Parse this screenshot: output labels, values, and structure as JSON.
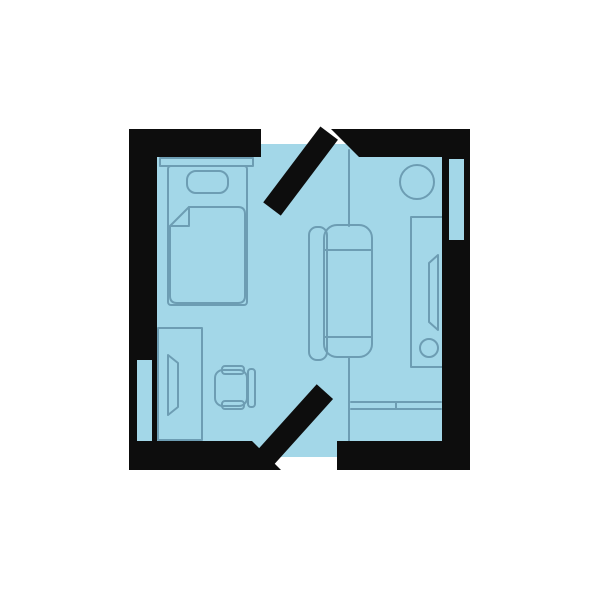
{
  "scene": {
    "type": "floor-plan-illustration",
    "canvas": {
      "width": 600,
      "height": 600,
      "background": "#FFFFFF"
    },
    "colors": {
      "floor": "#A3D7E8",
      "outline": "#6D9DB3",
      "wall": "#0D0D0D"
    },
    "rooms": [
      {
        "name": "bedroom-left",
        "contents": [
          "bed",
          "desk",
          "monitor",
          "office-chair"
        ]
      },
      {
        "name": "living-area-right",
        "contents": [
          "sofa",
          "tv-cabinet",
          "tv",
          "round-stool",
          "wall-shelf"
        ]
      }
    ],
    "elements": [
      {
        "name": "floor-area",
        "kind": "floor",
        "bbox": [
          144,
          144,
          312,
          313
        ]
      },
      {
        "name": "wall-top-left",
        "kind": "wall",
        "bbox": [
          129,
          129,
          132,
          28
        ]
      },
      {
        "name": "wall-top-right",
        "kind": "wall",
        "bbox": [
          331,
          129,
          139,
          28
        ],
        "note": "diagonal-cut left end"
      },
      {
        "name": "wall-left",
        "kind": "wall",
        "bbox": [
          129,
          129,
          28,
          341
        ]
      },
      {
        "name": "wall-right",
        "kind": "wall",
        "bbox": [
          442,
          129,
          28,
          341
        ]
      },
      {
        "name": "wall-bottom-left",
        "kind": "wall",
        "bbox": [
          129,
          441,
          152,
          29
        ],
        "note": "diagonal-cut right end"
      },
      {
        "name": "wall-bottom-right",
        "kind": "wall",
        "bbox": [
          337,
          441,
          133,
          29
        ]
      },
      {
        "name": "window-left",
        "kind": "window",
        "bbox": [
          137,
          360,
          15,
          81
        ]
      },
      {
        "name": "window-right",
        "kind": "window",
        "bbox": [
          449,
          159,
          15,
          81
        ]
      },
      {
        "name": "door-leaf-top",
        "kind": "door",
        "from": [
          272,
          209
        ],
        "to": [
          329,
          133
        ],
        "thickness": 22
      },
      {
        "name": "door-leaf-bottom",
        "kind": "door",
        "from": [
          266,
          457
        ],
        "to": [
          325,
          392
        ],
        "thickness": 22
      },
      {
        "name": "bed-headboard",
        "kind": "furniture",
        "bbox": [
          160,
          158,
          93,
          8
        ]
      },
      {
        "name": "bed-frame",
        "kind": "furniture",
        "bbox": [
          168,
          166,
          79,
          139
        ]
      },
      {
        "name": "bed-pillow",
        "kind": "furniture",
        "bbox": [
          187,
          171,
          41,
          22
        ]
      },
      {
        "name": "bed-blanket",
        "kind": "furniture",
        "bbox": [
          170,
          207,
          75,
          96
        ],
        "note": "folded top-left corner"
      },
      {
        "name": "desk",
        "kind": "furniture",
        "bbox": [
          158,
          328,
          44,
          112
        ]
      },
      {
        "name": "monitor",
        "kind": "furniture",
        "bbox": [
          168,
          355,
          10,
          60
        ]
      },
      {
        "name": "office-chair",
        "kind": "furniture",
        "bbox": [
          215,
          366,
          40,
          43
        ]
      },
      {
        "name": "sofa",
        "kind": "furniture",
        "bbox": [
          309,
          225,
          63,
          135
        ]
      },
      {
        "name": "partition-line-upper",
        "kind": "divider",
        "from": [
          349,
          150
        ],
        "to": [
          349,
          226
        ]
      },
      {
        "name": "partition-line-lower",
        "kind": "divider",
        "from": [
          349,
          357
        ],
        "to": [
          349,
          441
        ]
      },
      {
        "name": "wall-shelf",
        "kind": "furniture",
        "bbox": [
          351,
          402,
          91,
          7
        ]
      },
      {
        "name": "tv-cabinet",
        "kind": "furniture",
        "bbox": [
          411,
          217,
          31,
          150
        ]
      },
      {
        "name": "tv",
        "kind": "furniture",
        "bbox": [
          429,
          255,
          9,
          75
        ]
      },
      {
        "name": "cabinet-knob",
        "kind": "furniture",
        "center": [
          429,
          348
        ],
        "radius": 9
      },
      {
        "name": "round-stool",
        "kind": "furniture",
        "center": [
          417,
          182
        ],
        "radius": 17
      }
    ]
  }
}
